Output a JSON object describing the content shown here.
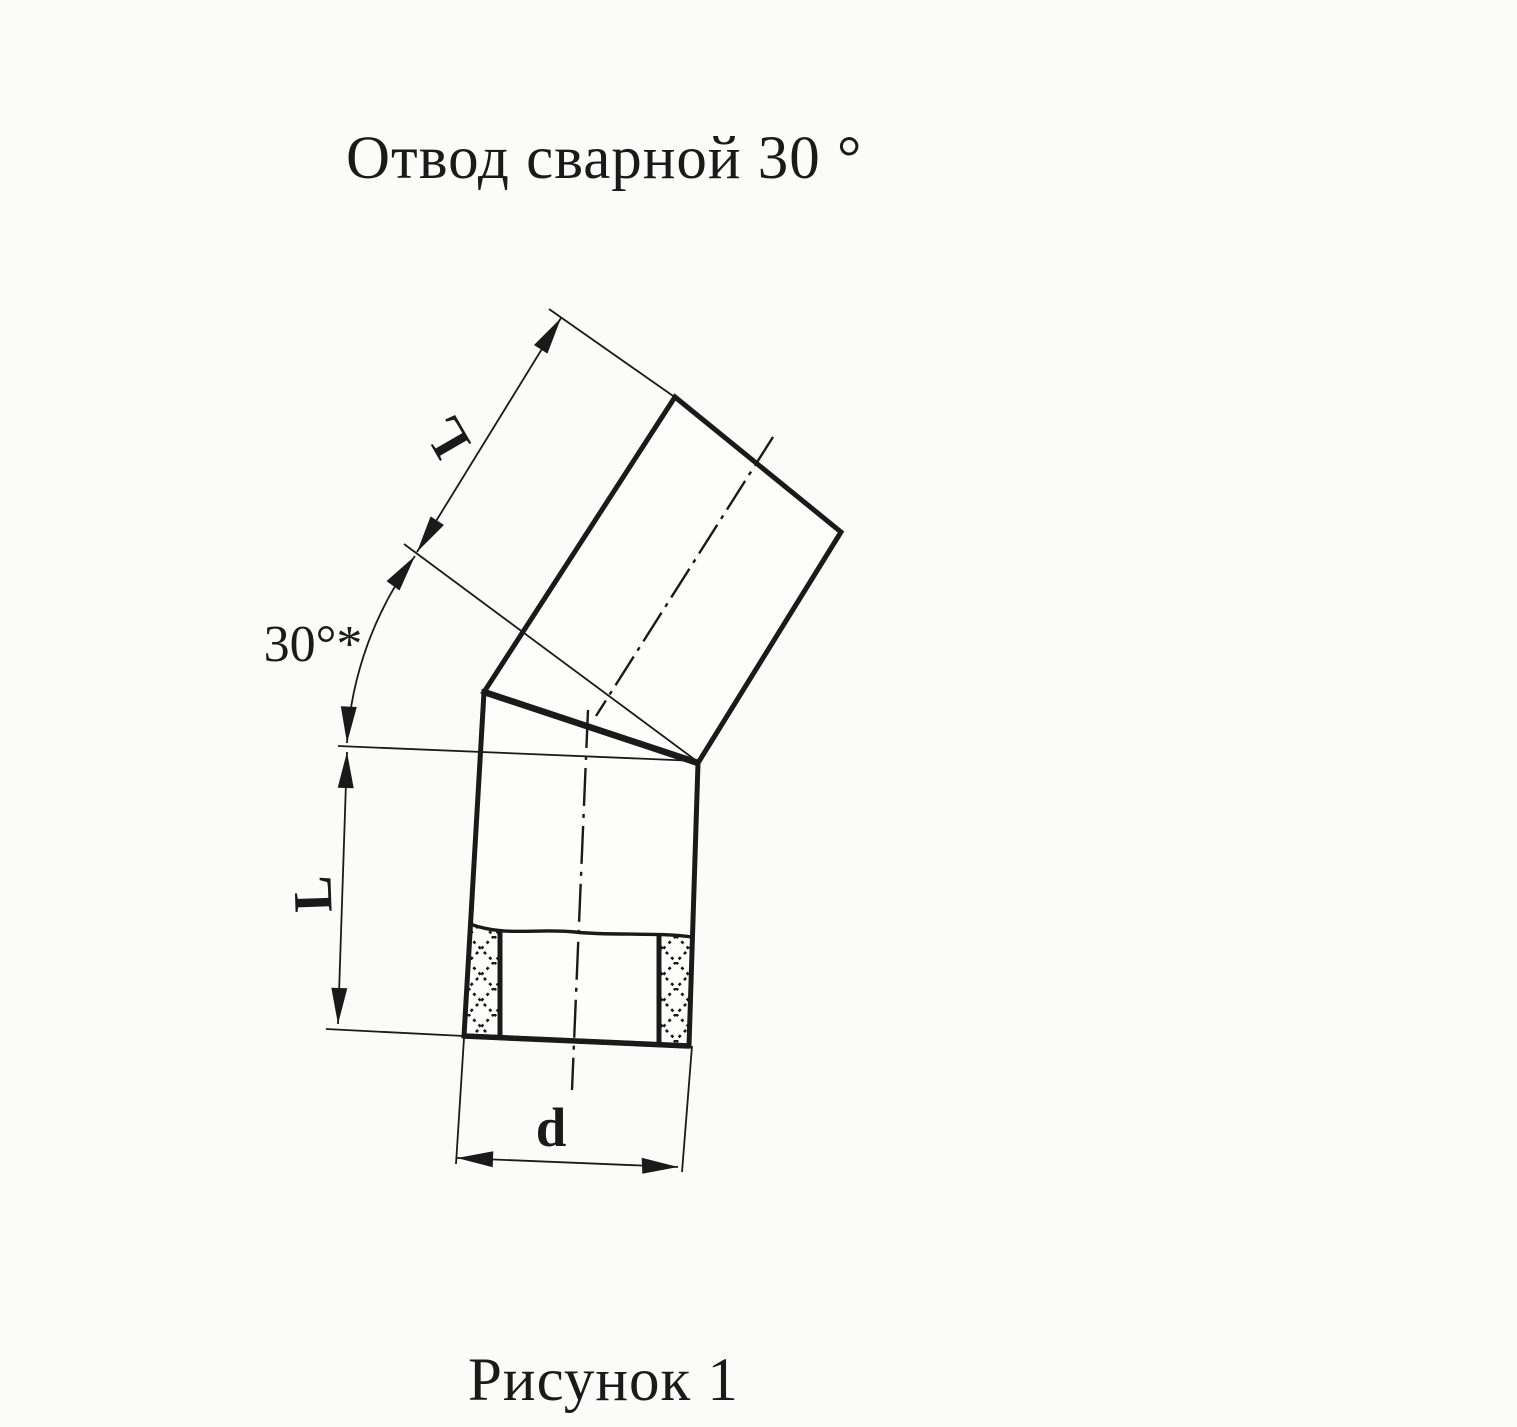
{
  "page": {
    "title": "Отвод сварной  30 °",
    "caption": "Рисунок 1"
  },
  "drawing": {
    "kind": "welded pipe elbow, mitered from two segments",
    "labels": {
      "length_upper": "L",
      "length_lower": "L",
      "diameter": "d",
      "angle": "30°*"
    }
  },
  "colors": {
    "ink": "#1a1a1a",
    "paper": "#fbfbf9"
  }
}
